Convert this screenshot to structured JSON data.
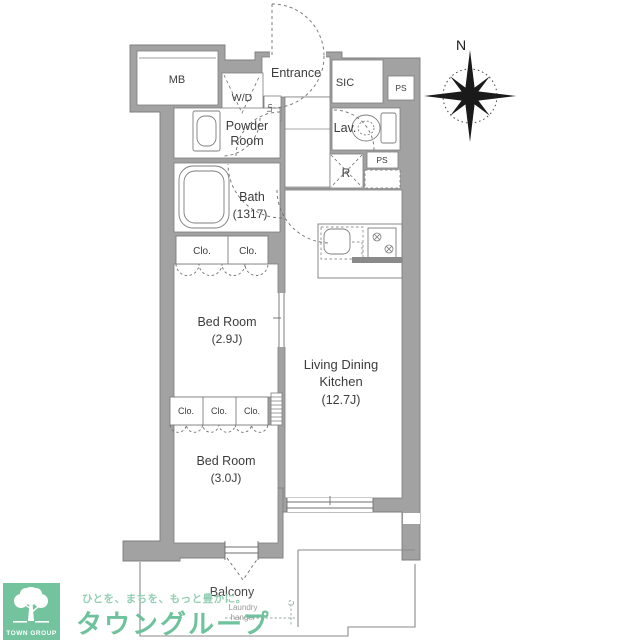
{
  "floorplan": {
    "compass": {
      "north_label": "N"
    },
    "labels": {
      "mb": "MB",
      "wd": "W/D",
      "linen": "Ln",
      "entrance": "Entrance",
      "sic": "SIC",
      "ps_top": "PS",
      "powder_room_line1": "Powder",
      "powder_room_line2": "Room",
      "lavatory": "Lav.",
      "ps_mid": "PS",
      "refrigerator": "R",
      "bath_line1": "Bath",
      "bath_line2": "(1317)",
      "bedroom1_line1": "Bed Room",
      "bedroom1_line2": "(2.9J)",
      "bedroom2_line1": "Bed Room",
      "bedroom2_line2": "(3.0J)",
      "ldk_line1": "Living Dining",
      "ldk_line2": "Kitchen",
      "ldk_line3": "(12.7J)",
      "balcony": "Balcony",
      "laundry_line1": "Laundry",
      "laundry_line2": "hanger"
    },
    "closets_upper": [
      "Clo.",
      "Clo."
    ],
    "closets_lower": [
      "Clo.",
      "Clo.",
      "Clo."
    ]
  },
  "branding": {
    "logo_square_text": "TOWN GROUP",
    "company_name": "タウングループ",
    "tagline": "ひとを、まちを、もっと豊かに。",
    "colors": {
      "logo_bg": "#72c39e",
      "company_green": "#6ec29d",
      "tagline_green": "#93cfb4"
    }
  },
  "style": {
    "wall_gray": "#a2a2a2",
    "line_gray": "#7d7d7d",
    "text_dark": "#3c3c3c"
  }
}
